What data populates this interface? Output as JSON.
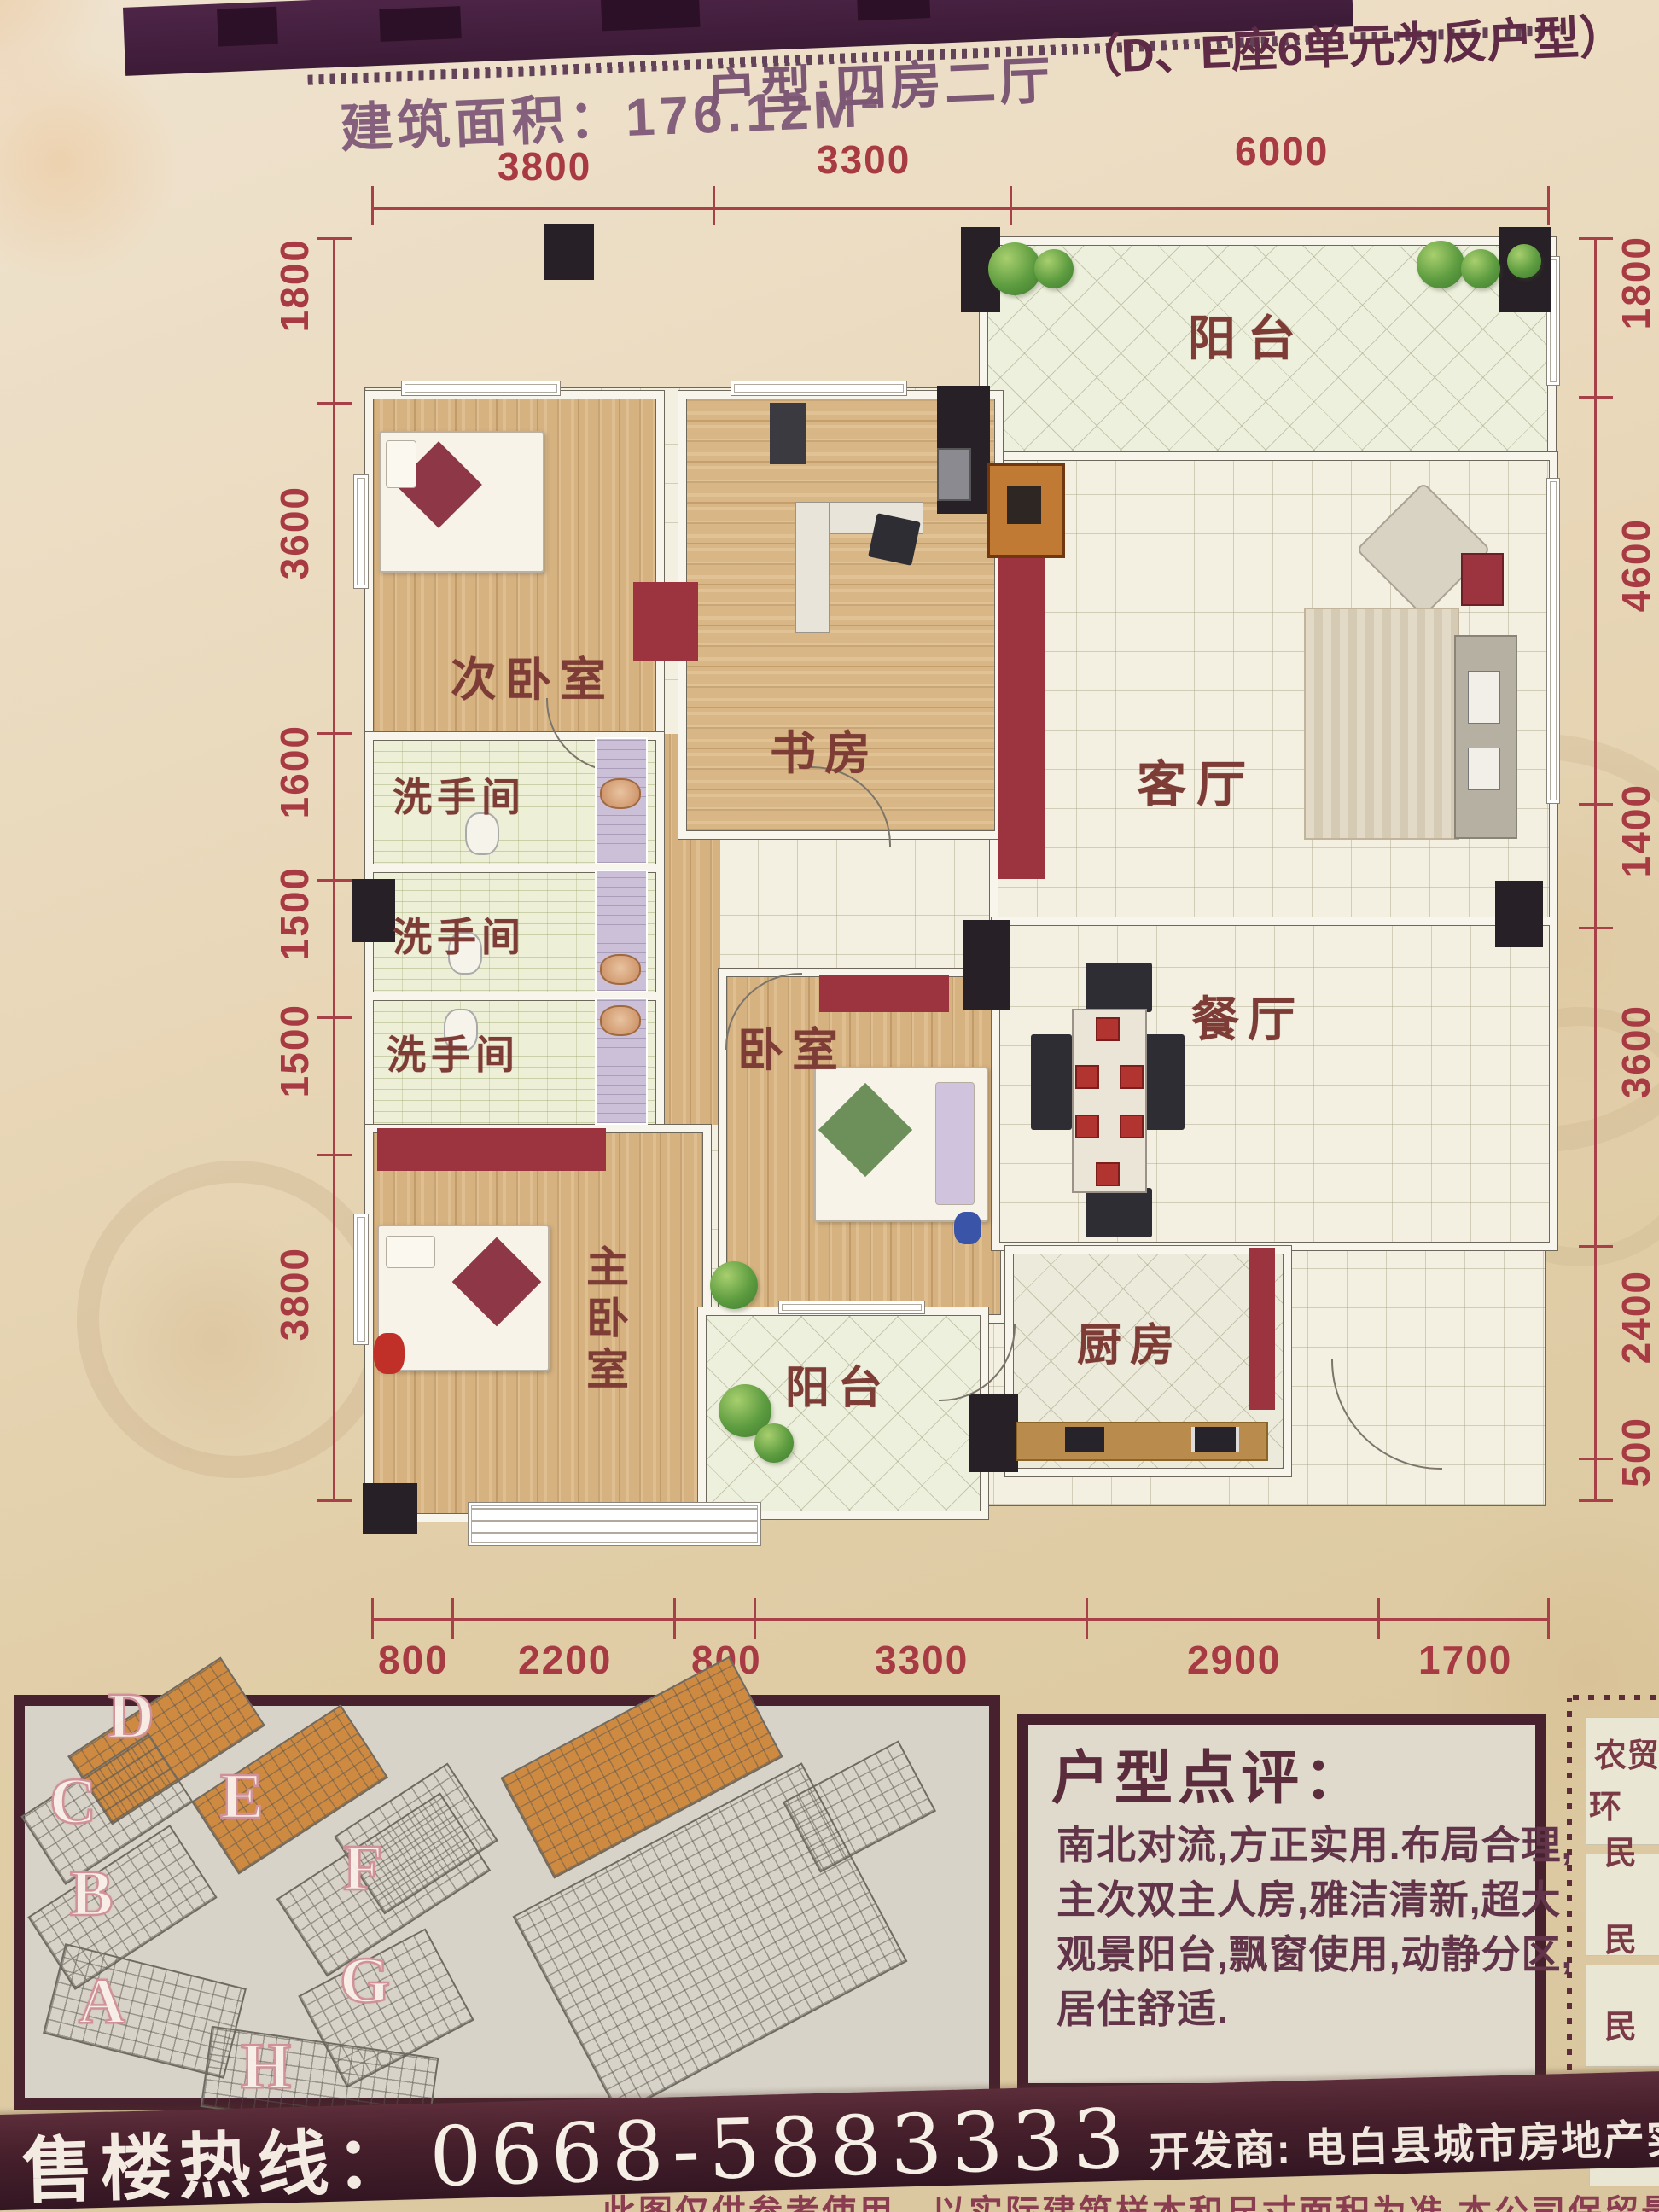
{
  "header": {
    "area_label": "建筑面积：176.12M",
    "area_exp": "2",
    "type_label": "户型:四房二厅",
    "type_note": "（D、E座6单元为反户型）"
  },
  "plan": {
    "dims_top": [
      "3800",
      "3300",
      "6000"
    ],
    "dims_left": [
      "1800",
      "3600",
      "1600",
      "1500",
      "1500",
      "3800"
    ],
    "dims_right": [
      "1800",
      "4600",
      "1400",
      "3600",
      "2400",
      "500"
    ],
    "dims_bottom": [
      "800",
      "2200",
      "800",
      "3300",
      "2900",
      "1700"
    ],
    "rooms": {
      "balcony_top": "阳台",
      "living": "客厅",
      "bedroom2": "次卧室",
      "study": "书房",
      "wash1": "洗手间",
      "wash2": "洗手间",
      "wash3": "洗手间",
      "bedroom": "卧室",
      "dining": "餐厅",
      "master": "主卧室",
      "balcony_bottom": "阳台",
      "kitchen": "厨房"
    }
  },
  "site_plan": {
    "buildings": [
      "D",
      "C",
      "E",
      "B",
      "F",
      "A",
      "G",
      "H"
    ]
  },
  "review": {
    "title": "户型点评：",
    "lines": [
      "南北对流,方正实用.布局合理,",
      "主次双主人房,雅洁清新,超大",
      "观景阳台,飘窗使用,动静分区,",
      "居住舒适."
    ]
  },
  "side_strip": {
    "items": [
      "农贸",
      "环",
      "民",
      "民",
      "民",
      "县"
    ]
  },
  "footer": {
    "hotline_label": "售楼热线：",
    "hotline_number": "0668-5883333",
    "developer": "开发商: 电白县城市房地产实业有限公司",
    "disclaimer": "此图仅供参考使用，以实际建筑样本和尺寸面积为准 本公司保留最终解释权"
  },
  "colors": {
    "accent_red": "#9c3440",
    "dim_red": "#a83a44",
    "banner_brown": "#47222e",
    "text_maroon": "#7e3c36"
  }
}
